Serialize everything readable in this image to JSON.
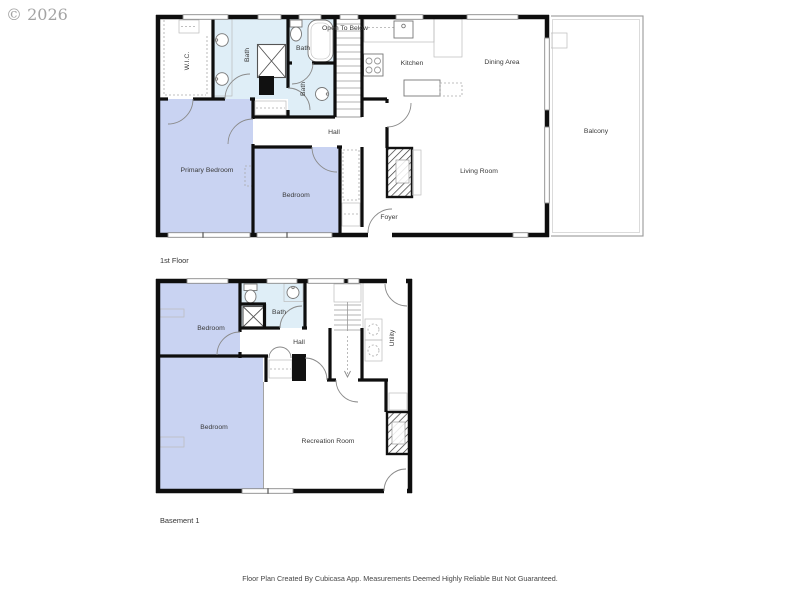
{
  "watermark": "© 2026",
  "footer": "Floor Plan Created By Cubicasa App. Measurements Deemed Highly Reliable But Not Guaranteed.",
  "colors": {
    "bedroom_fill": "#c9d3f2",
    "bath_fill": "#dfeef7",
    "wall": "#0e0e0e",
    "fixture_line": "#999999",
    "label_text": "#3a3a3a",
    "watermark_text": "#a3a3a3"
  },
  "floors": {
    "first": {
      "name": "1st Floor",
      "rooms": {
        "wic": "W.I.C.",
        "bath_ensuite": "Bath",
        "bath_upper": "Bath",
        "bath_lower": "Bath",
        "open_to_below": "Open To Below",
        "kitchen": "Kitchen",
        "dining": "Dining Area",
        "balcony": "Balcony",
        "hall": "Hall",
        "primary_bedroom": "Primary Bedroom",
        "bedroom": "Bedroom",
        "living_room": "Living Room",
        "foyer": "Foyer"
      }
    },
    "basement": {
      "name": "Basement 1",
      "rooms": {
        "bedroom_upper": "Bedroom",
        "bath": "Bath",
        "hall": "Hall",
        "utility": "Utility",
        "bedroom_lower": "Bedroom",
        "recreation": "Recreation Room"
      }
    }
  }
}
